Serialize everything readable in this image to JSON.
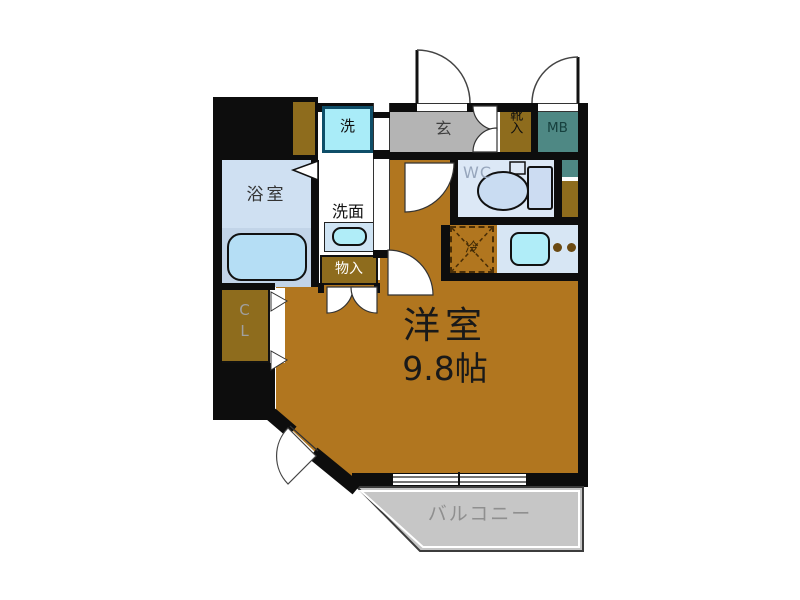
{
  "floorplan": {
    "labels": {
      "main_room": "洋室",
      "main_room_size": "9.8帖",
      "bathroom": "浴室",
      "washbasin": "洗面",
      "washing_machine": "洗",
      "entrance": "玄",
      "shoe_storage": "靴入",
      "meter_box": "MB",
      "toilet": "WC",
      "refrigerator": "冷",
      "storage": "物入",
      "closet": "CL",
      "balcony": "バルコニー"
    },
    "colors": {
      "wall": "#0d0d0d",
      "room_floor": "#b1761f",
      "entrance_floor": "#b4b4b4",
      "balcony_floor": "#c6c6c6",
      "storage_brown": "#8e6c1d",
      "meter_box_teal": "#4e8884",
      "bathroom_blue": "#cfe0f2",
      "fixture_cyan": "#a9ecf8",
      "counter_blue": "#d7e6f4"
    }
  }
}
